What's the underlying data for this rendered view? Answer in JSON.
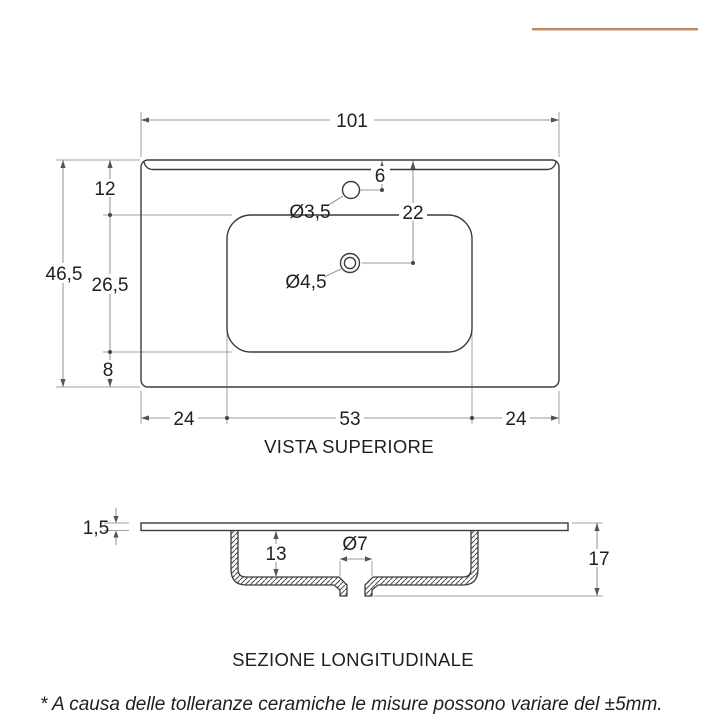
{
  "accent_color": "#c6875a",
  "top_view": {
    "caption": "VISTA SUPERIORE",
    "dims": {
      "total_width": "101",
      "total_depth": "46,5",
      "back_edge_to_basin": "12",
      "basin_span": "26,5",
      "basin_to_front": "8",
      "faucet_offset": "6",
      "faucet_hole_diameter": "Ø3,5",
      "drain_offset": "22",
      "drain_hole_diameter": "Ø4,5",
      "left_margin": "24",
      "basin_width": "53",
      "right_margin": "24"
    }
  },
  "section_view": {
    "caption": "SEZIONE LONGITUDINALE",
    "dims": {
      "top_thickness": "1,5",
      "basin_inner_depth": "13",
      "drain_diameter": "Ø7",
      "total_height": "17"
    }
  },
  "footer_note": "* A causa delle tolleranze ceramiche le misure possono variare del ±5mm."
}
